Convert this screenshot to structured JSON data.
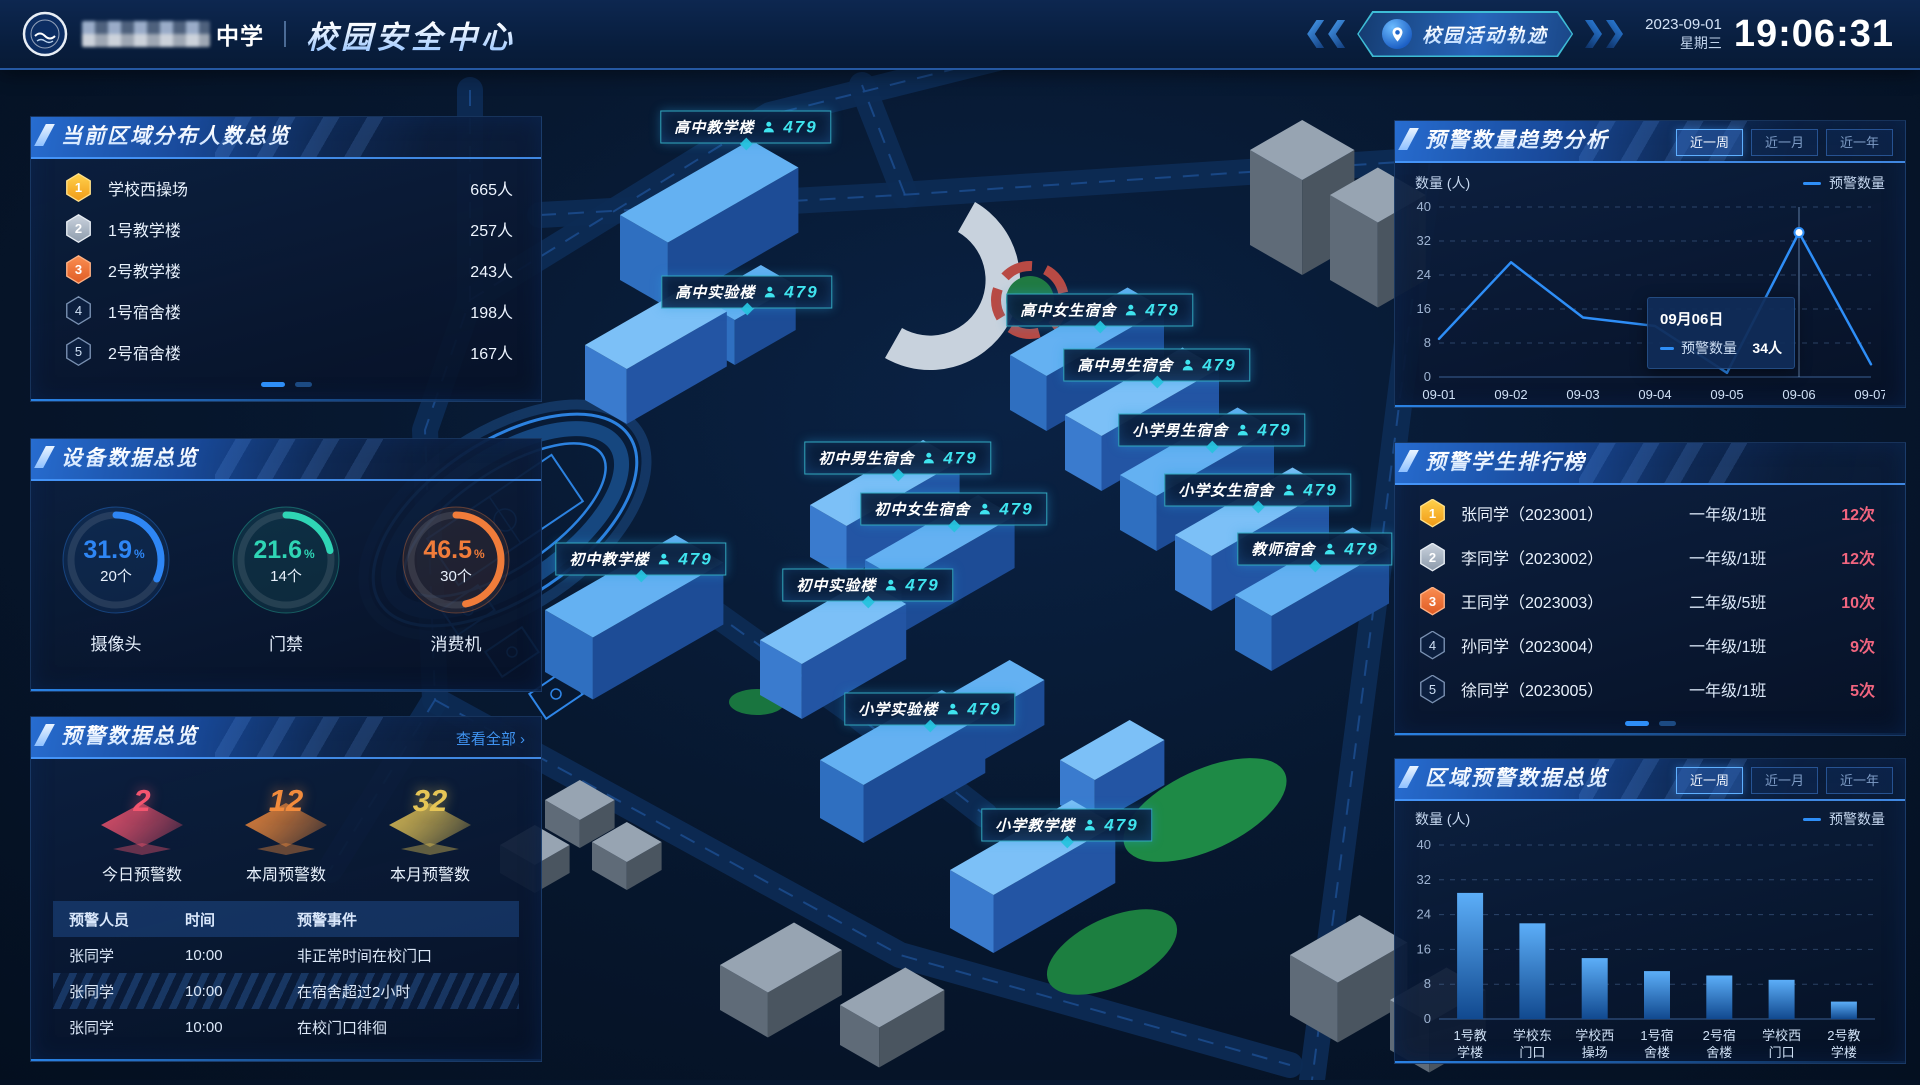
{
  "header": {
    "school_suffix": "中学",
    "title": "校园安全中心",
    "track_button": "校园活动轨迹",
    "date": "2023-09-01",
    "weekday": "星期三",
    "time": "19:06:31"
  },
  "left": {
    "area_panel": {
      "title": "当前区域分布人数总览",
      "items": [
        {
          "rank": "1",
          "name": "学校西操场",
          "value": "665人"
        },
        {
          "rank": "2",
          "name": "1号教学楼",
          "value": "257人"
        },
        {
          "rank": "3",
          "name": "2号教学楼",
          "value": "243人"
        },
        {
          "rank": "4",
          "name": "1号宿舍楼",
          "value": "198人"
        },
        {
          "rank": "5",
          "name": "2号宿舍楼",
          "value": "167人"
        }
      ]
    },
    "device_panel": {
      "title": "设备数据总览",
      "gauges": [
        {
          "percent": "31.9",
          "count": "20个",
          "label": "摄像头",
          "color": "#2e86f5"
        },
        {
          "percent": "21.6",
          "count": "14个",
          "label": "门禁",
          "color": "#2fd5b5"
        },
        {
          "percent": "46.5",
          "count": "30个",
          "label": "消费机",
          "color": "#f07c3a"
        }
      ]
    },
    "warning_panel": {
      "title": "预警数据总览",
      "view_all": "查看全部 ›",
      "stats": [
        {
          "value": "2",
          "label": "今日预警数",
          "color": "#f3556f"
        },
        {
          "value": "12",
          "label": "本周预警数",
          "color": "#f28b3c"
        },
        {
          "value": "32",
          "label": "本月预警数",
          "color": "#e6c556"
        }
      ],
      "table": {
        "headers": [
          "预警人员",
          "时间",
          "预警事件"
        ],
        "rows": [
          [
            "张同学",
            "10:00",
            "非正常时间在校门口"
          ],
          [
            "张同学",
            "10:00",
            "在宿舍超过2小时"
          ],
          [
            "张同学",
            "10:00",
            "在校门口徘徊"
          ]
        ]
      }
    }
  },
  "map": {
    "labels": [
      {
        "name": "高中教学楼",
        "count": "479",
        "x": 746,
        "y": 127
      },
      {
        "name": "高中实验楼",
        "count": "479",
        "x": 747,
        "y": 292
      },
      {
        "name": "高中女生宿舍",
        "count": "479",
        "x": 1100,
        "y": 310
      },
      {
        "name": "高中男生宿舍",
        "count": "479",
        "x": 1157,
        "y": 365
      },
      {
        "name": "小学男生宿舍",
        "count": "479",
        "x": 1212,
        "y": 430
      },
      {
        "name": "初中男生宿舍",
        "count": "479",
        "x": 898,
        "y": 458
      },
      {
        "name": "小学女生宿舍",
        "count": "479",
        "x": 1258,
        "y": 490
      },
      {
        "name": "初中女生宿舍",
        "count": "479",
        "x": 954,
        "y": 509
      },
      {
        "name": "教师宿舍",
        "count": "479",
        "x": 1315,
        "y": 549
      },
      {
        "name": "初中教学楼",
        "count": "479",
        "x": 641,
        "y": 559
      },
      {
        "name": "初中实验楼",
        "count": "479",
        "x": 868,
        "y": 585
      },
      {
        "name": "小学实验楼",
        "count": "479",
        "x": 930,
        "y": 709
      },
      {
        "name": "小学教学楼",
        "count": "479",
        "x": 1067,
        "y": 825
      }
    ]
  },
  "right": {
    "trend_panel": {
      "title": "预警数量趋势分析",
      "tabs": [
        "近一周",
        "近一月",
        "近一年"
      ],
      "active_tab": 0,
      "ylabel": "数量 (人)",
      "legend": "预警数量"
    },
    "ranking_panel": {
      "title": "预警学生排行榜",
      "items": [
        {
          "rank": "1",
          "name": "张同学（2023001）",
          "class": "一年级/1班",
          "count": "12次"
        },
        {
          "rank": "2",
          "name": "李同学（2023002）",
          "class": "一年级/1班",
          "count": "12次"
        },
        {
          "rank": "3",
          "name": "王同学（2023003）",
          "class": "二年级/5班",
          "count": "10次"
        },
        {
          "rank": "4",
          "name": "孙同学（2023004）",
          "class": "一年级/1班",
          "count": "9次"
        },
        {
          "rank": "5",
          "name": "徐同学（2023005）",
          "class": "一年级/1班",
          "count": "5次"
        }
      ]
    },
    "region_panel": {
      "title": "区域预警数据总览",
      "tabs": [
        "近一周",
        "近一月",
        "近一年"
      ],
      "active_tab": 0,
      "ylabel": "数量 (人)",
      "legend": "预警数量"
    }
  },
  "chart_data": [
    {
      "type": "line",
      "panel": "预警数量趋势分析",
      "x": [
        "09-01",
        "09-02",
        "09-03",
        "09-04",
        "09-05",
        "09-06",
        "09-07"
      ],
      "series": [
        {
          "name": "预警数量",
          "values": [
            9,
            27,
            14,
            12,
            1,
            34,
            3
          ]
        }
      ],
      "ylabel": "数量 (人)",
      "ylim": [
        0,
        40
      ],
      "yticks": [
        0,
        8,
        16,
        24,
        32,
        40
      ],
      "grid": true,
      "legend_position": "top-right",
      "tooltip": {
        "date": "09月06日",
        "series": "预警数量",
        "value": "34人",
        "index": 5
      }
    },
    {
      "type": "bar",
      "panel": "区域预警数据总览",
      "categories": [
        "1号教学楼",
        "学校东门口",
        "学校西操场",
        "1号宿舍楼",
        "2号宿舍楼",
        "学校西门口",
        "2号教学楼"
      ],
      "series": [
        {
          "name": "预警数量",
          "values": [
            29,
            22,
            14,
            11,
            10,
            9,
            4
          ]
        }
      ],
      "ylabel": "数量 (人)",
      "ylim": [
        0,
        40
      ],
      "yticks": [
        0,
        8,
        16,
        24,
        32,
        40
      ],
      "grid": true,
      "legend_position": "top-right"
    }
  ]
}
